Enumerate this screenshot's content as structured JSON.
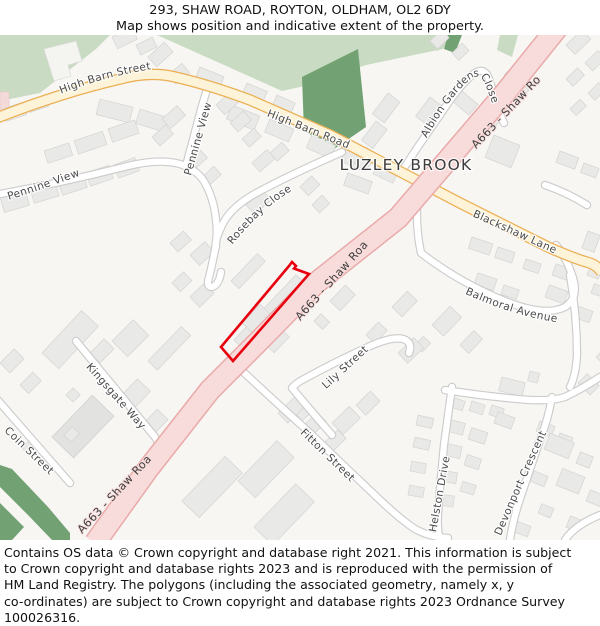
{
  "title": {
    "line1": "293, SHAW ROAD, ROYTON, OLDHAM, OL2 6DY",
    "line2": "Map shows position and indicative extent of the property."
  },
  "map": {
    "place": "LUZLEY BROOK",
    "roads": {
      "high_barn_street": "High Barn Street",
      "high_barn_road": "High Barn Road",
      "blackshaw_lane": "Blackshaw Lane",
      "a663_shaw_road": "A663 - Shaw Road",
      "pennine_view": "Pennine View",
      "rosebay_close": "Rosebay Close",
      "albion_gardens_close": "Albion Gardens Close",
      "balmoral_avenue": "Balmoral Avenue",
      "lily_street": "Lily Street",
      "kingsgate_way": "Kingsgate Way",
      "coin_street": "Coin Street",
      "fitton_street": "Fitton Street",
      "helston_drive": "Helston Drive",
      "devonport_crescent": "Devonport Crescent"
    },
    "colors": {
      "a_road_fill": "#f8dcdb",
      "a_road_casing": "#e9aaa9",
      "secondary_fill": "#fdf3d8",
      "secondary_casing": "#ecaf53",
      "minor_fill": "#ffffff",
      "minor_casing": "#cccccc",
      "greenspace": "#c9dbc2",
      "woodland": "#72a274",
      "building": "#e9e9e7",
      "property_outline": "#e8000e"
    }
  },
  "footer": {
    "lines": [
      "Contains OS data © Crown copyright and database right 2021. This information is subject",
      "to Crown copyright and database rights 2023 and is reproduced with the permission of",
      "HM Land Registry. The polygons (including the associated geometry, namely x, y",
      "co-ordinates) are subject to Crown copyright and database rights 2023 Ordnance Survey",
      "100026316."
    ]
  }
}
